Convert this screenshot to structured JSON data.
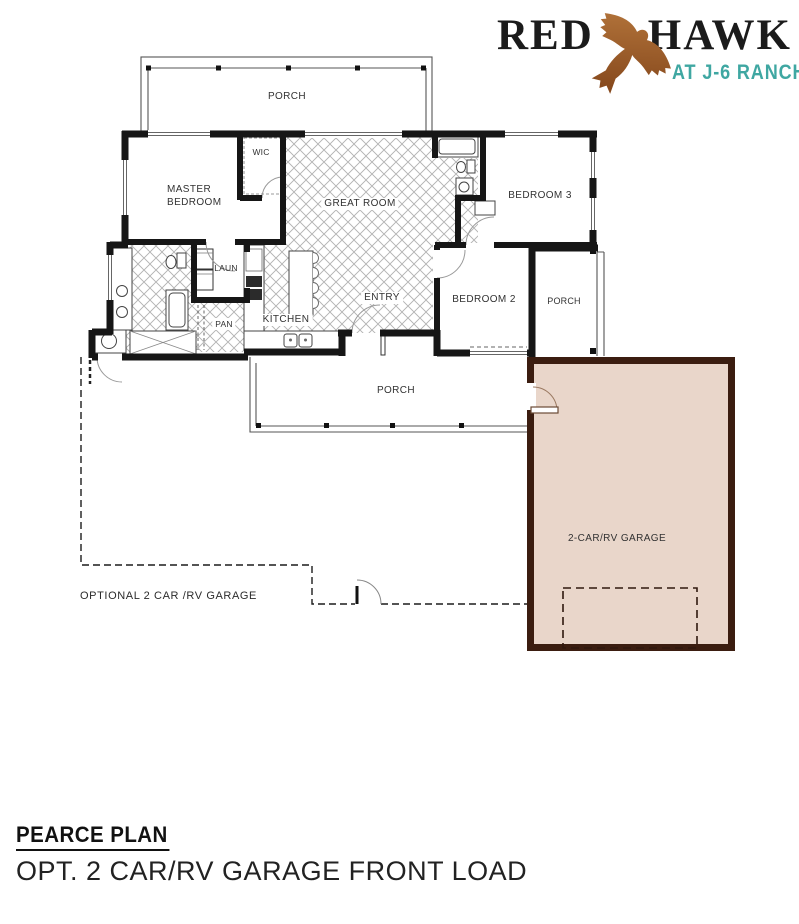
{
  "logo": {
    "brand_left": "RED",
    "brand_right": "HAWK",
    "tagline": "AT J-6 RANCH",
    "hawk_icon": "soaring-hawk",
    "colors": {
      "brand_text": "#1b1b1b",
      "tagline_teal": "#3fa7a2",
      "hawk_brown": "#9a5628"
    }
  },
  "floor_plan": {
    "rooms": {
      "porch_top": "PORCH",
      "master_bedroom": "MASTER BEDROOM",
      "wic": "WIC",
      "great_room": "GREAT ROOM",
      "bedroom_3": "BEDROOM 3",
      "laundry": "LAUN",
      "pantry": "PAN",
      "kitchen": "KITCHEN",
      "entry": "ENTRY",
      "bedroom_2": "BEDROOM 2",
      "porch_right": "PORCH",
      "porch_bottom": "PORCH",
      "garage": "2-CAR/RV GARAGE",
      "optional_garage": "OPTIONAL 2 CAR /RV GARAGE"
    },
    "colors": {
      "garage_fill": "#e9d6ca",
      "garage_border": "#3b1d10",
      "walls": "#161616",
      "hatch": "#b3b3b3"
    }
  },
  "footer": {
    "plan_name": "PEARCE PLAN",
    "plan_option": "OPT. 2 CAR/RV GARAGE FRONT LOAD"
  }
}
